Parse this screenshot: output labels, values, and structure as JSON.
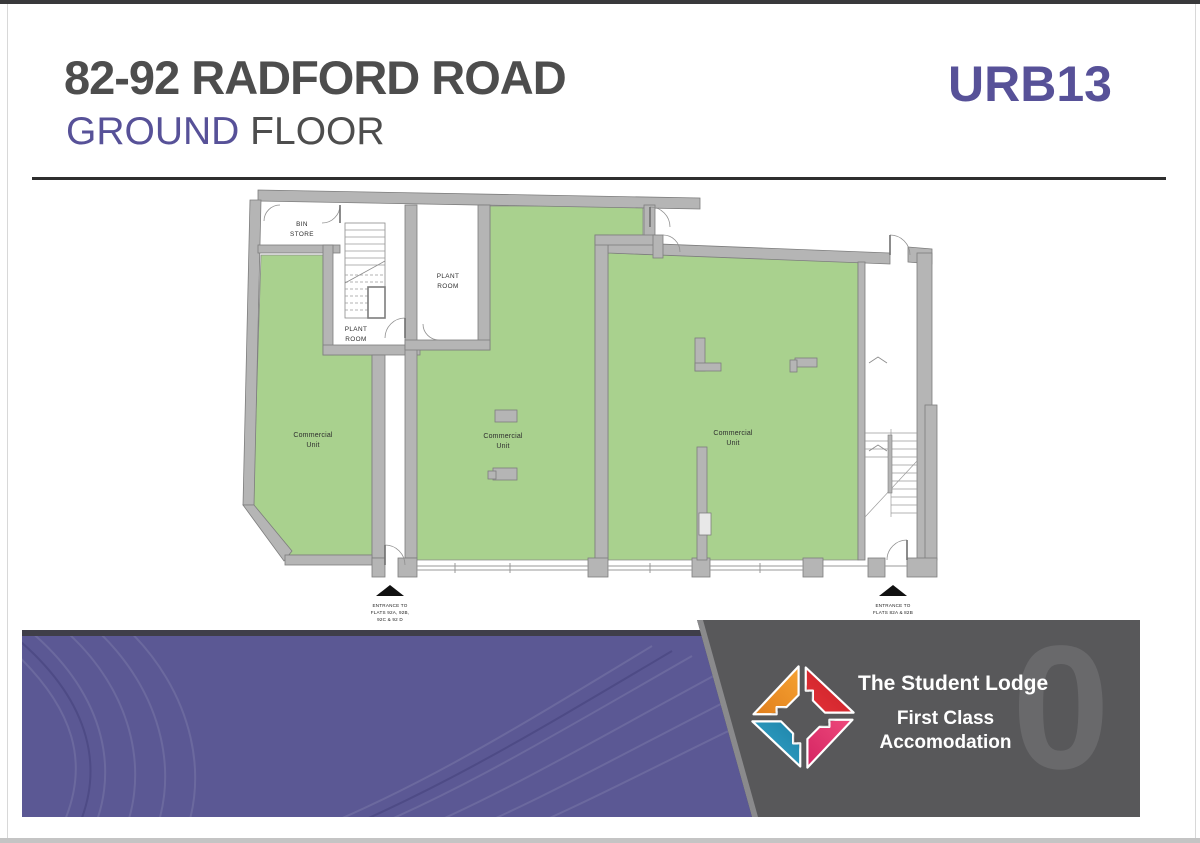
{
  "header": {
    "title": "82-92 RADFORD ROAD",
    "subtitle_highlight": "GROUND",
    "subtitle_rest": " FLOOR",
    "ref": "URB13"
  },
  "plan": {
    "rooms": {
      "bin_line1": "BIN",
      "bin_line2": "STORE",
      "plant_line1": "PLANT",
      "plant_line2": "ROOM",
      "commercial_line1": "Commercial",
      "commercial_line2": "Unit"
    },
    "entrance_left": {
      "line1": "ENTRANCE TO",
      "line2": "FLATS 92A, 92B,",
      "line3": "92C & 92 D"
    },
    "entrance_right": {
      "line1": "ENTRANCE TO",
      "line2": "FLATS 82A & 82B"
    }
  },
  "footer": {
    "brand_name": "The Student Lodge",
    "tagline_line1": "First Class",
    "tagline_line2": "Accomodation",
    "floor_number": "0"
  },
  "colors": {
    "accent_purple": "#575198",
    "unit_green": "#a9d18e",
    "wall_gray": "#b5b5b5",
    "footer_gray": "#58585a",
    "band_purple": "#5b5894",
    "logo_orange": "#f0932b",
    "logo_red": "#d6252c",
    "logo_blue": "#2798c0",
    "logo_pink": "#e33d72"
  }
}
